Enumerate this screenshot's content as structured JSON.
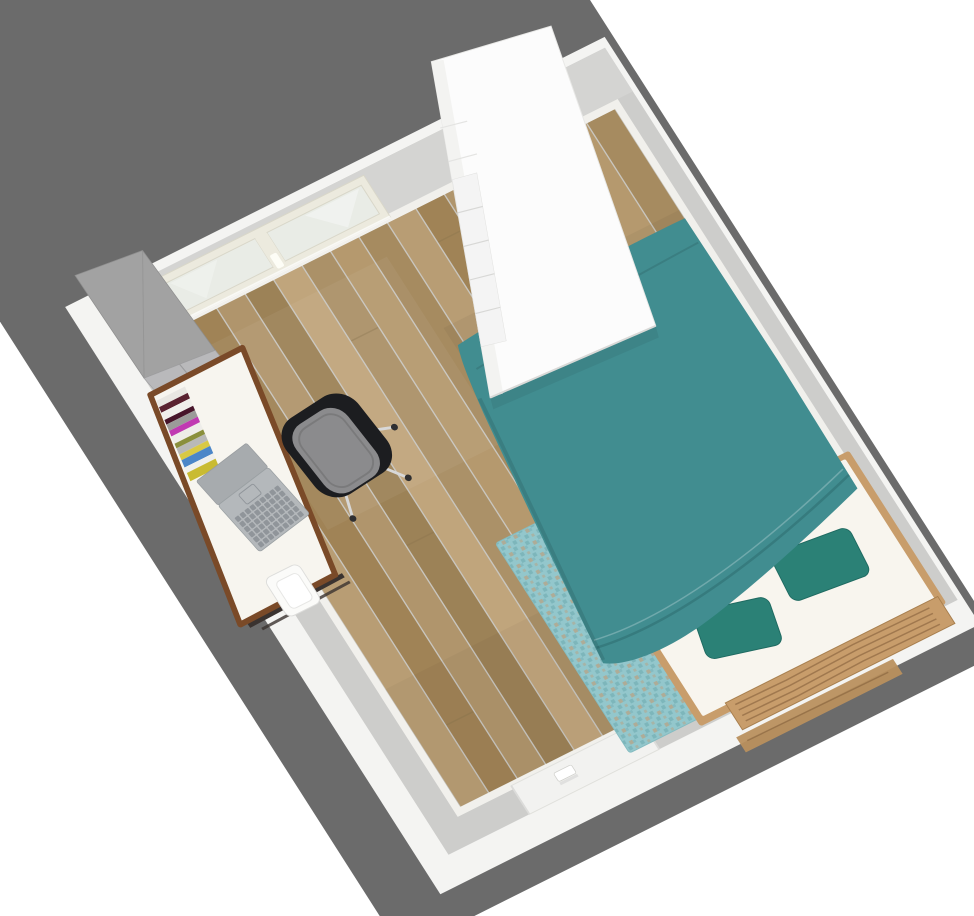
{
  "app": {
    "view": "aerial-3d-room-view"
  },
  "scene": {
    "objects": [
      {
        "name": "window"
      },
      {
        "name": "metal-cabinet"
      },
      {
        "name": "desk"
      },
      {
        "name": "magazine-stack"
      },
      {
        "name": "laptop"
      },
      {
        "name": "office-chair"
      },
      {
        "name": "waste-bin"
      },
      {
        "name": "rug"
      },
      {
        "name": "bed"
      },
      {
        "name": "duvet"
      },
      {
        "name": "pillow-left"
      },
      {
        "name": "pillow-right"
      },
      {
        "name": "wardrobe"
      },
      {
        "name": "door"
      }
    ]
  },
  "colors": {
    "ground": "#6b6b6b",
    "wall_top": "#cdcdcb",
    "wall_top_nw": "#d4d4d2",
    "wall_inner": "#f1f0ec",
    "wall_outer": "#f4f4f2",
    "floor_gap": "#c9c6bf",
    "duvet": "#418d90",
    "duvet_fold": "#2e6e70",
    "pillow": "#2b8176",
    "pillow_edge": "#1f6a61",
    "sheet": "#f8f5ee",
    "bed_wood": "#c89d6b",
    "rail_wood": "#b9905e",
    "wood_streak": "#6e4c2c",
    "rug_base": "#93c7cc",
    "rug_dot": "#7db6bb",
    "rug_fleck": "#b3a78e",
    "desk_top": "#f7f5ef",
    "desk_edge": "#7a4a28",
    "desk_frame": "#3a3330",
    "chair_shell": "#1c1d20",
    "chair_cushion": "#8b8b8d",
    "chrome": "#d8d8d8",
    "wheel": "#2f2f31",
    "cabinet_top": "#a2a2a2",
    "cabinet_front": "#b9b9bb",
    "cabinet_seam": "#9b9b9d",
    "laptop_panel": "#a7abae",
    "laptop_deck": "#b4b8bb",
    "laptop_key": "#90959a",
    "bin": "#fbfbf9",
    "bin_inner": "#ffffff",
    "door": "#f2f2f0",
    "window_frame": "#eceade",
    "glass": "#e9ece6",
    "wardrobe_top": "#fcfcfc",
    "wardrobe_side": "#f3f3f1",
    "drawer_face": "#f4f4f4",
    "drawer_seam": "#d8d8d6",
    "joint_dark": "#8f7850"
  },
  "floor": {
    "plank_shades": [
      "#ab9168",
      "#b89d74",
      "#9c8257",
      "#b5996e",
      "#a08356",
      "#c0a57c",
      "#a68b60",
      "#b0956c"
    ]
  },
  "books": {
    "spine_colors": [
      "#e9e7e2",
      "#5a2230",
      "#f0efeb",
      "#47152a",
      "#9b9b99",
      "#c03ab2",
      "#eeede9",
      "#8a8f3c",
      "#b9b9b7",
      "#d9c944",
      "#4b86c8",
      "#efefed",
      "#c9bb32"
    ]
  }
}
